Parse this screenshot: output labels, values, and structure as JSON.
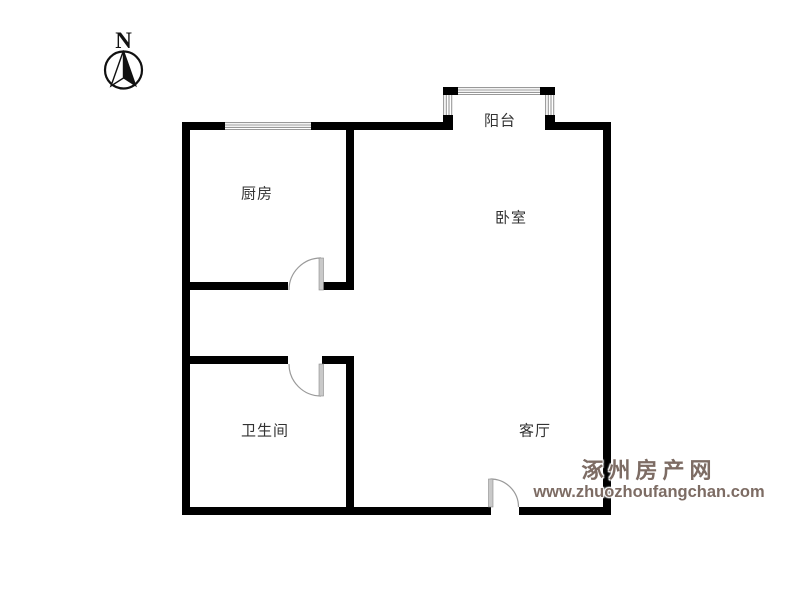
{
  "compass": {
    "label": "N"
  },
  "rooms": {
    "kitchen": {
      "label": "厨房"
    },
    "balcony": {
      "label": "阳台"
    },
    "bedroom": {
      "label": "卧室"
    },
    "bathroom": {
      "label": "卫生间"
    },
    "living_room": {
      "label": "客厅"
    }
  },
  "watermark": {
    "site_name": "涿州房产网",
    "site_url": "www.zhuozhoufangchan.com"
  },
  "colors": {
    "wall": "#000000",
    "room_label": "#333333",
    "window_stripe": "#999999",
    "door_leaf": "#c9c9c9",
    "door_arc": "#9a9a9a",
    "watermark": "#7d6c64",
    "background": "#ffffff"
  }
}
